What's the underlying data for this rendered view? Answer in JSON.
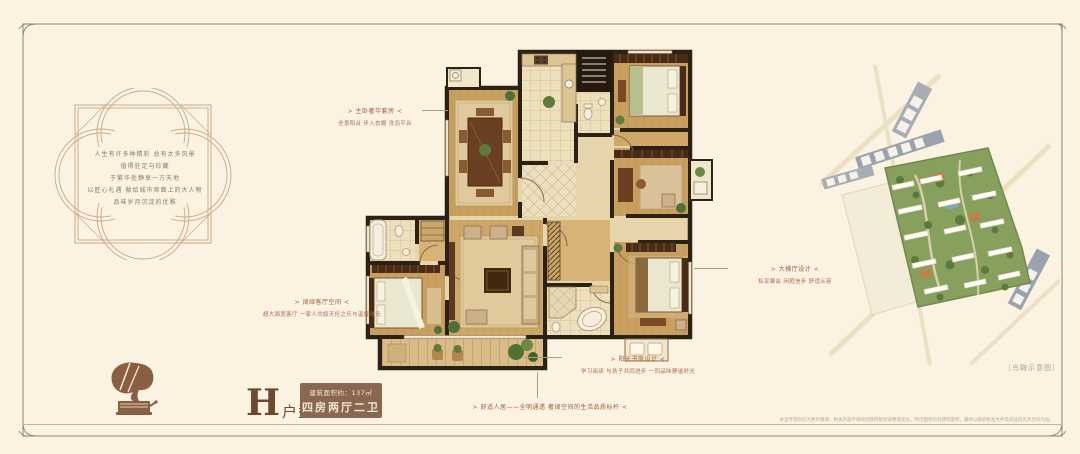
{
  "theme": {
    "background": "#fbf2e1",
    "frame_color": "#9a8266",
    "accent_red_brown": "#a15c42",
    "brand_brown": "#8a6750",
    "wall_color": "#2c2115",
    "wood_floor": "#c89f5e"
  },
  "icons": {
    "gramophone": "gramophone-silhouette",
    "quatrefoil": "quatrefoil-ornament-frame"
  },
  "intro": {
    "lines": [
      "人生有许多种精彩 总有太多风景",
      "值得驻足与珍藏",
      "于繁华处静享一方天地",
      "以匠心礼遇 献给城市席面上的大人物",
      "品味岁月沉淀的优雅"
    ]
  },
  "unit": {
    "letter": "H",
    "suffix": "户型",
    "area": "建筑面积约：137㎡",
    "layout": "四房两厅二卫"
  },
  "callouts": {
    "suite": {
      "title": "≻ 主卧奢华套房 ≺",
      "desc": "全景阳台 步入衣帽 洗浴平台"
    },
    "living": {
      "title": "≻ 阔绰客厅空间 ≺",
      "desc": "超大面宽客厅 一家人共叙天伦之乐与温馨时光"
    },
    "hall": {
      "title": "≻ 大横厅设计 ≺",
      "desc": "私享聚会 闲庭信步 舒适从容"
    },
    "study": {
      "title": "≻ 阳光书房设计 ≺",
      "desc": "学习阅读 与孩子共同进步 一同品味静谧时光"
    },
    "banner": {
      "title": "≻ 舒适人居——全明通透 奢阔空间的生活品质标杆 ≺"
    }
  },
  "siteplan": {
    "caption": "〔鸟瞰示意图〕"
  },
  "footer": {
    "disclaimer": "本宣传资料仅为要约邀请，相关内容不排除因政府规划调整而变化，所示面积均为建筑面积，最终以政府批准文件及商品房买卖合同为准。"
  }
}
